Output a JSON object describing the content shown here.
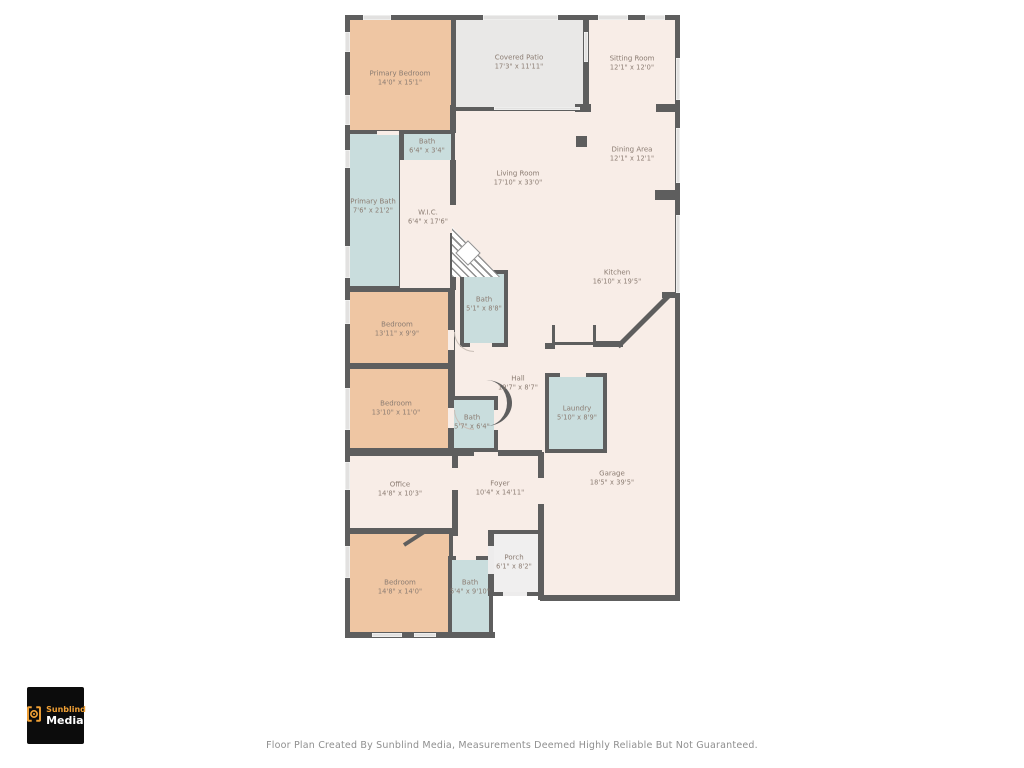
{
  "palette": {
    "wall": "#5E5E5E",
    "living_cream": "#F8EDE7",
    "bedroom_peach": "#EFC6A3",
    "bath_blue": "#C9DDDD",
    "patio_gray": "#E9E8E7",
    "porch_gray": "#F0EFEF",
    "label_text": "#8B7C72",
    "logo_accent": "#F0A035",
    "logo_bg": "#0C0C0C"
  },
  "rooms": [
    {
      "id": "primary-bedroom",
      "name": "Primary Bedroom",
      "dims": "14'0\" x 15'1\""
    },
    {
      "id": "covered-patio",
      "name": "Covered Patio",
      "dims": "17'3\" x 11'11\""
    },
    {
      "id": "sitting-room",
      "name": "Sitting Room",
      "dims": "12'1\" x 12'0\""
    },
    {
      "id": "bath-primary-hall",
      "name": "Bath",
      "dims": "6'4\" x 3'4\""
    },
    {
      "id": "primary-bath",
      "name": "Primary Bath",
      "dims": "7'6\" x 21'2\""
    },
    {
      "id": "wic",
      "name": "W.I.C.",
      "dims": "6'4\" x 17'6\""
    },
    {
      "id": "living-room",
      "name": "Living Room",
      "dims": "17'10\" x 33'0\""
    },
    {
      "id": "dining-area",
      "name": "Dining Area",
      "dims": "12'1\" x 12'1\""
    },
    {
      "id": "kitchen",
      "name": "Kitchen",
      "dims": "16'10\" x 19'5\""
    },
    {
      "id": "bath-hall-upper",
      "name": "Bath",
      "dims": "5'1\" x 8'8\""
    },
    {
      "id": "bedroom-2",
      "name": "Bedroom",
      "dims": "13'11\" x 9'9\""
    },
    {
      "id": "bedroom-3",
      "name": "Bedroom",
      "dims": "13'10\" x 11'0\""
    },
    {
      "id": "hall",
      "name": "Hall",
      "dims": "19'7\" x 8'7\""
    },
    {
      "id": "bath-hall-lower",
      "name": "Bath",
      "dims": "5'7\" x 6'4\""
    },
    {
      "id": "laundry",
      "name": "Laundry",
      "dims": "5'10\" x 8'9\""
    },
    {
      "id": "office",
      "name": "Office",
      "dims": "14'8\" x 10'3\""
    },
    {
      "id": "foyer",
      "name": "Foyer",
      "dims": "10'4\" x 14'11\""
    },
    {
      "id": "garage",
      "name": "Garage",
      "dims": "18'5\" x 39'5\""
    },
    {
      "id": "bedroom-4",
      "name": "Bedroom",
      "dims": "14'8\" x 14'0\""
    },
    {
      "id": "bath-guest",
      "name": "Bath",
      "dims": "5'4\" x 9'10\""
    },
    {
      "id": "porch",
      "name": "Porch",
      "dims": "6'1\" x 8'2\""
    }
  ],
  "logo": {
    "icon": "camera-brackets-icon",
    "brand_line1": "Sunblind",
    "brand_line2": "Media"
  },
  "footer": {
    "text": "Floor Plan Created By Sunblind Media, Measurements Deemed Highly Reliable But Not Guaranteed."
  }
}
